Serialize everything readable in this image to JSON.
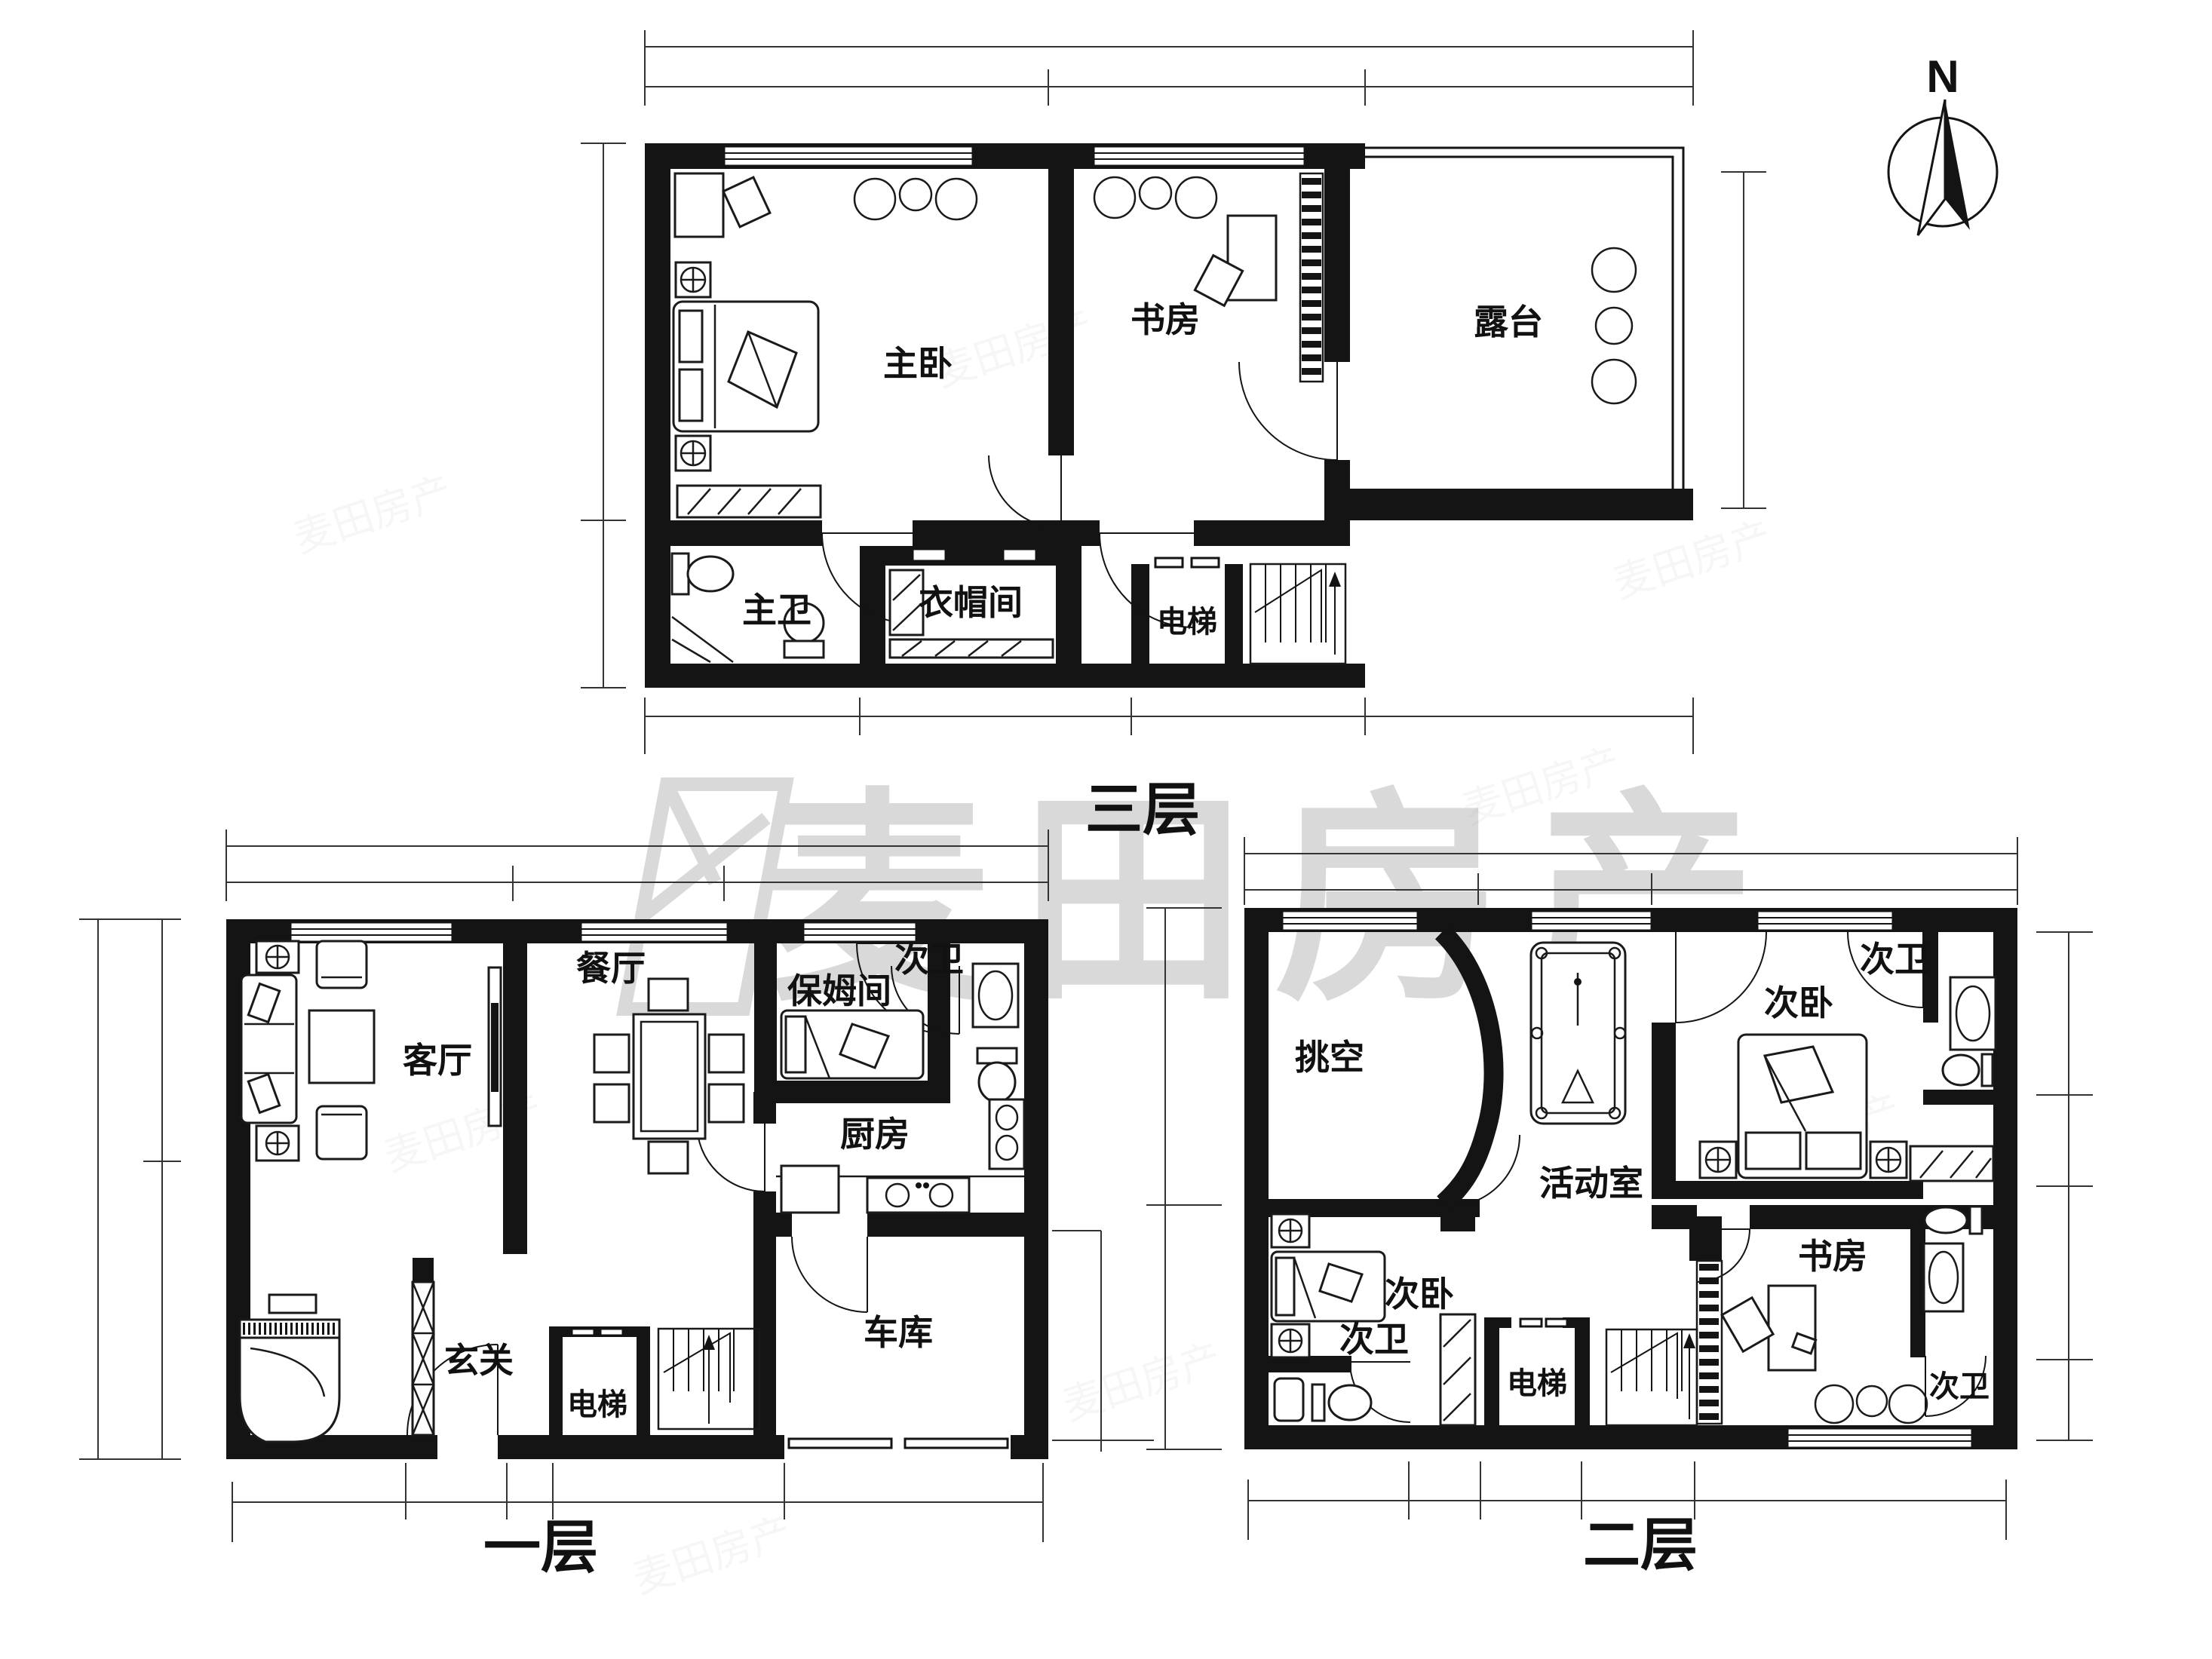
{
  "compass": {
    "label": "N"
  },
  "watermark": {
    "brand": "麦田房产"
  },
  "floors": {
    "third": {
      "label": "三层",
      "rooms": {
        "master_bedroom": "主卧",
        "study": "书房",
        "terrace": "露台",
        "master_bath": "主卫",
        "cloakroom": "衣帽间",
        "elevator": "电梯"
      }
    },
    "first": {
      "label": "一层",
      "rooms": {
        "living_room": "客厅",
        "dining_room": "餐厅",
        "bath": "次卫",
        "nanny_room": "保姆间",
        "kitchen": "厨房",
        "foyer": "玄关",
        "elevator": "电梯",
        "garage": "车库"
      }
    },
    "second": {
      "label": "二层",
      "rooms": {
        "void": "挑空",
        "activity_room": "活动室",
        "bedroom_top": "次卧",
        "bath_top": "次卫",
        "bedroom_bottom": "次卧",
        "bath_bottom": "次卫",
        "study": "书房",
        "elevator": "电梯",
        "bath_right": "次卫"
      }
    }
  }
}
